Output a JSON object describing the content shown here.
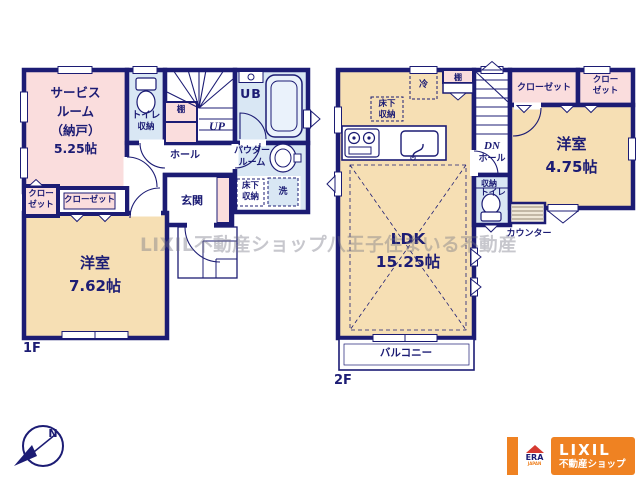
{
  "watermark": "LIXIL不動産ショップ八王子住まいる不動産",
  "colors": {
    "wall_navy": "#1c1c74",
    "room_cream": "#f6dfb4",
    "storage_pink": "#fadddd",
    "wet_area_blue": "#d9e7f4",
    "logo_orange": "#ef8222",
    "era_red": "#d63a30"
  },
  "compass": {
    "north_label": "N"
  },
  "floor1": {
    "floor_label": "1F",
    "service_room": "サービス\nルーム\n（納戸）\n5.25帖",
    "toilet": "トイレ",
    "toilet_storage": "収納",
    "shelf": "棚",
    "stairs_up": "UP",
    "unit_bath": "UB",
    "hall": "ホール",
    "powder_room": "パウダー\nルーム",
    "underfloor_storage": "床下\n収納",
    "laundry": "洗",
    "entrance": "玄関",
    "closet_small": "クロー\nゼット",
    "closet_wide": "クローゼット",
    "bedroom": "洋室\n7.62帖"
  },
  "floor2": {
    "floor_label": "2F",
    "refrigerator": "冷",
    "shelf": "棚",
    "underfloor_storage": "床下\n収納",
    "ldk": "LDK\n15.25帖",
    "stairs_down": "DN",
    "hall": "ホール",
    "storage": "収納",
    "toilet": "トイレ",
    "closet_wide": "クローゼット",
    "closet_corner": "クロー\nゼット",
    "bedroom": "洋室\n4.75帖",
    "counter": "カウンター",
    "balcony": "バルコニー"
  },
  "logo": {
    "brand": "LIXIL",
    "brand_sub": "不動産ショップ",
    "era": "ERA",
    "era_caption": "JAPAN"
  }
}
